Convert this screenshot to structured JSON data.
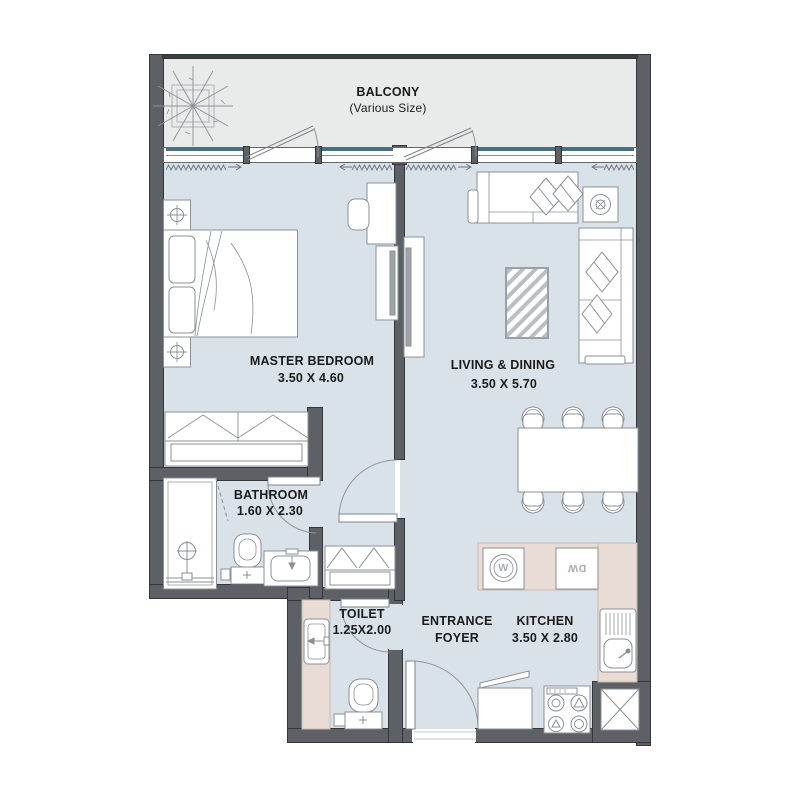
{
  "plan": {
    "balcony": {
      "name": "BALCONY",
      "note": "(Various Size)"
    },
    "master_bedroom": {
      "name": "MASTER BEDROOM",
      "dims": "3.50 X 4.60"
    },
    "living_dining": {
      "name": "LIVING & DINING",
      "dims": "3.50 X 5.70"
    },
    "bathroom": {
      "name": "BATHROOM",
      "dims": "1.60 X 2.30"
    },
    "toilet": {
      "name": "TOILET",
      "dims": "1.25X2.00"
    },
    "entrance_foyer": {
      "line1": "ENTRANCE",
      "line2": "FOYER"
    },
    "kitchen": {
      "name": "KITCHEN",
      "dims": "3.50 X 2.80"
    },
    "appliances": {
      "washer": "W",
      "dishwasher": "DW"
    }
  },
  "colors": {
    "wall": "#5d6165",
    "floor": "#d9e2e9",
    "balcony_floor": "#e9eaea",
    "counter": "#e8dcd4",
    "window_sill": "#4a7080",
    "furniture_line": "#8a9096",
    "text": "#1b1b1b"
  }
}
